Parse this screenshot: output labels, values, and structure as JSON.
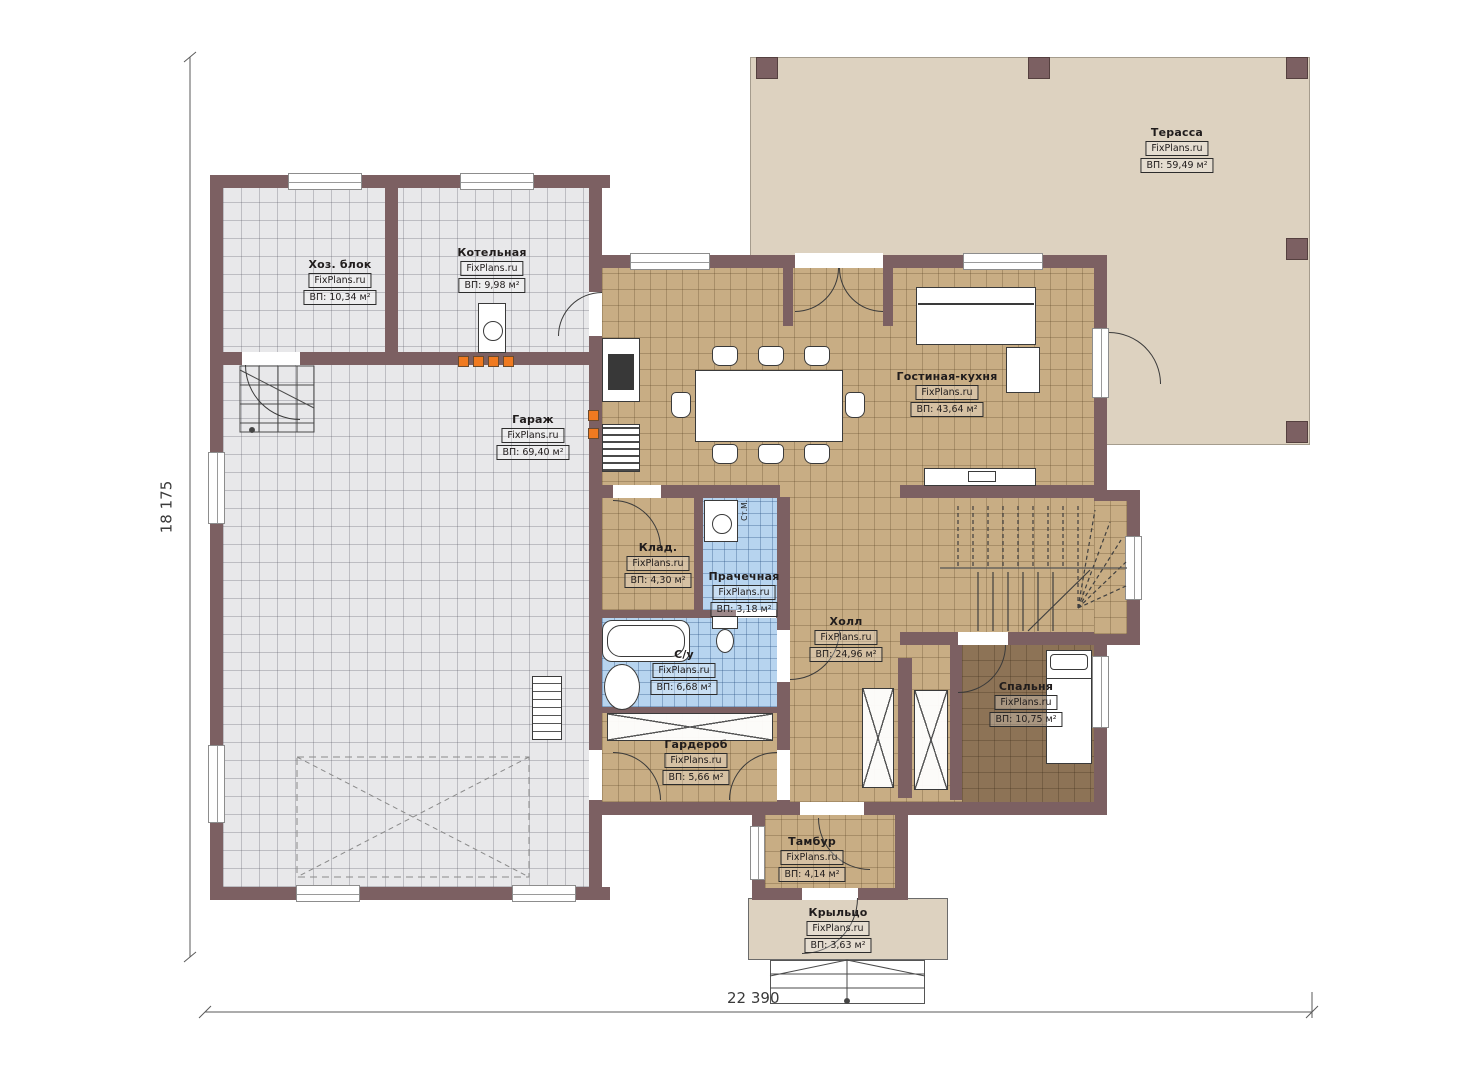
{
  "plan": {
    "brand": "FixPlans.ru",
    "dimensions": {
      "width": "22 390",
      "height": "18 175"
    },
    "rooms": [
      {
        "name": "Терасса",
        "brand": "FixPlans.ru",
        "area": "ВП: 59,49 м²"
      },
      {
        "name": "Хоз. блок",
        "brand": "FixPlans.ru",
        "area": "ВП: 10,34 м²"
      },
      {
        "name": "Котельная",
        "brand": "FixPlans.ru",
        "area": "ВП: 9,98 м²"
      },
      {
        "name": "Гараж",
        "brand": "FixPlans.ru",
        "area": "ВП: 69,40 м²"
      },
      {
        "name": "Гостиная-кухня",
        "brand": "FixPlans.ru",
        "area": "ВП: 43,64 м²"
      },
      {
        "name": "Клад.",
        "brand": "FixPlans.ru",
        "area": "ВП: 4,30 м²"
      },
      {
        "name": "Прачечная",
        "brand": "FixPlans.ru",
        "area": "ВП: 3,18 м²"
      },
      {
        "name": "С/у",
        "brand": "FixPlans.ru",
        "area": "ВП: 6,68 м²"
      },
      {
        "name": "Холл",
        "brand": "FixPlans.ru",
        "area": "ВП: 24,96 м²"
      },
      {
        "name": "Спальня",
        "brand": "FixPlans.ru",
        "area": "ВП: 10,75 м²"
      },
      {
        "name": "Гардероб",
        "brand": "FixPlans.ru",
        "area": "ВП: 5,66 м²"
      },
      {
        "name": "Тамбур",
        "brand": "FixPlans.ru",
        "area": "ВП: 4,14 м²"
      },
      {
        "name": "Крыльцо",
        "brand": "FixPlans.ru",
        "area": "ВП: 3,63 м²"
      }
    ],
    "annotations": {
      "washing_machine": "Ст.М."
    },
    "colors": {
      "wall": "#7c6062",
      "floor_gray": "#e8e8ea",
      "floor_tan": "#c8ad84",
      "floor_blue": "#b7d4ef",
      "floor_bedroom": "#8d7356",
      "terrace": "#ddd2c0",
      "accent_orange": "#f07a20"
    }
  }
}
